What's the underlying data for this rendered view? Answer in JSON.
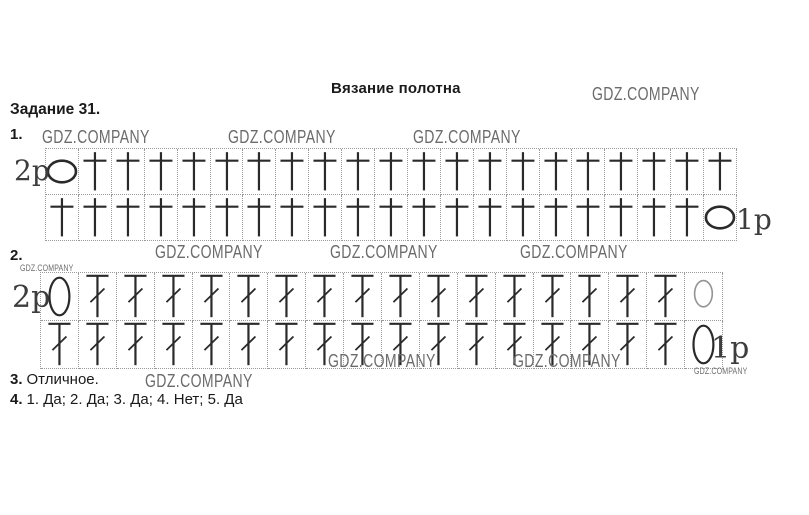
{
  "page": {
    "title": "Вязание полотна",
    "task_heading": "Задание 31.",
    "items": {
      "item1_label": "1.",
      "item2_label": "2.",
      "item3_label": "3.",
      "item3_text": "Отличное.",
      "item4_label": "4.",
      "item4_text": "1. Да; 2. Да; 3. Да; 4. Нет; 5. Да"
    }
  },
  "watermark": {
    "text": "GDZ.COMPANY",
    "color": "#6b6b6b"
  },
  "symbol_color": "#2a2a2a",
  "diagram1": {
    "row_label_top": "2р",
    "row_label_bottom": "1р",
    "columns": 21,
    "row_height": 46,
    "rows": [
      {
        "name": "row-2",
        "cells": [
          "chain",
          "sc",
          "sc",
          "sc",
          "sc",
          "sc",
          "sc",
          "sc",
          "sc",
          "sc",
          "sc",
          "sc",
          "sc",
          "sc",
          "sc",
          "sc",
          "sc",
          "sc",
          "sc",
          "sc",
          "sc"
        ]
      },
      {
        "name": "row-1",
        "cells": [
          "sc",
          "sc",
          "sc",
          "sc",
          "sc",
          "sc",
          "sc",
          "sc",
          "sc",
          "sc",
          "sc",
          "sc",
          "sc",
          "sc",
          "sc",
          "sc",
          "sc",
          "sc",
          "sc",
          "sc",
          "chain"
        ]
      }
    ]
  },
  "diagram2": {
    "row_label_top": "2р",
    "row_label_bottom": "1р",
    "columns": 18,
    "row_height": 48,
    "rows": [
      {
        "name": "row-2",
        "cells": [
          "chain-tall",
          "dc",
          "dc",
          "dc",
          "dc",
          "dc",
          "dc",
          "dc",
          "dc",
          "dc",
          "dc",
          "dc",
          "dc",
          "dc",
          "dc",
          "dc",
          "dc",
          "chain-tall-light"
        ]
      },
      {
        "name": "row-1",
        "cells": [
          "dc",
          "dc",
          "dc",
          "dc",
          "dc",
          "dc",
          "dc",
          "dc",
          "dc",
          "dc",
          "dc",
          "dc",
          "dc",
          "dc",
          "dc",
          "dc",
          "dc",
          "chain-tall"
        ]
      }
    ]
  }
}
